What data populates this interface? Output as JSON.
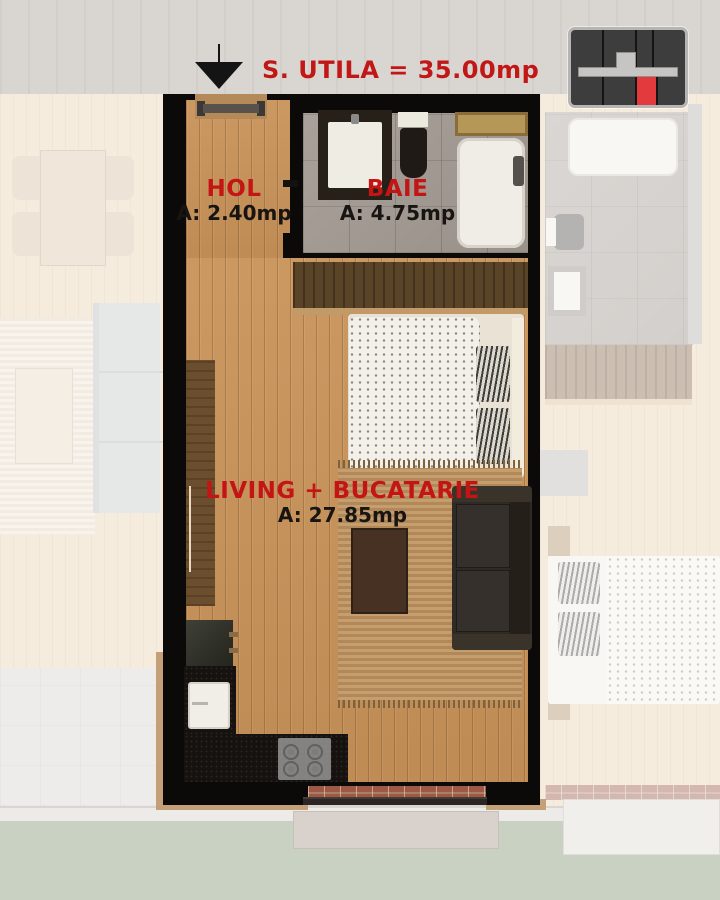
{
  "title": {
    "text": "S. UTILA = 35.00mp"
  },
  "rooms": [
    {
      "name": "HOL",
      "area": "A: 2.40mp"
    },
    {
      "name": "BAIE",
      "area": "A: 4.75mp"
    },
    {
      "name": "LIVING + BUCATARIE",
      "area": "A: 27.85mp"
    }
  ],
  "minimap": {
    "description": "building key plan with highlighted unit",
    "highlight_color": "#e23a3d",
    "units_color": "#3e3d3d",
    "corridor_color": "#c6c5c3"
  },
  "colors": {
    "accent_red": "#c41414",
    "label_black": "#171411",
    "wall_black": "#0b0a09",
    "wood_floor": "#c9935a",
    "bath_tile": "#a29a92",
    "lawn_green": "#c9d2c2"
  }
}
